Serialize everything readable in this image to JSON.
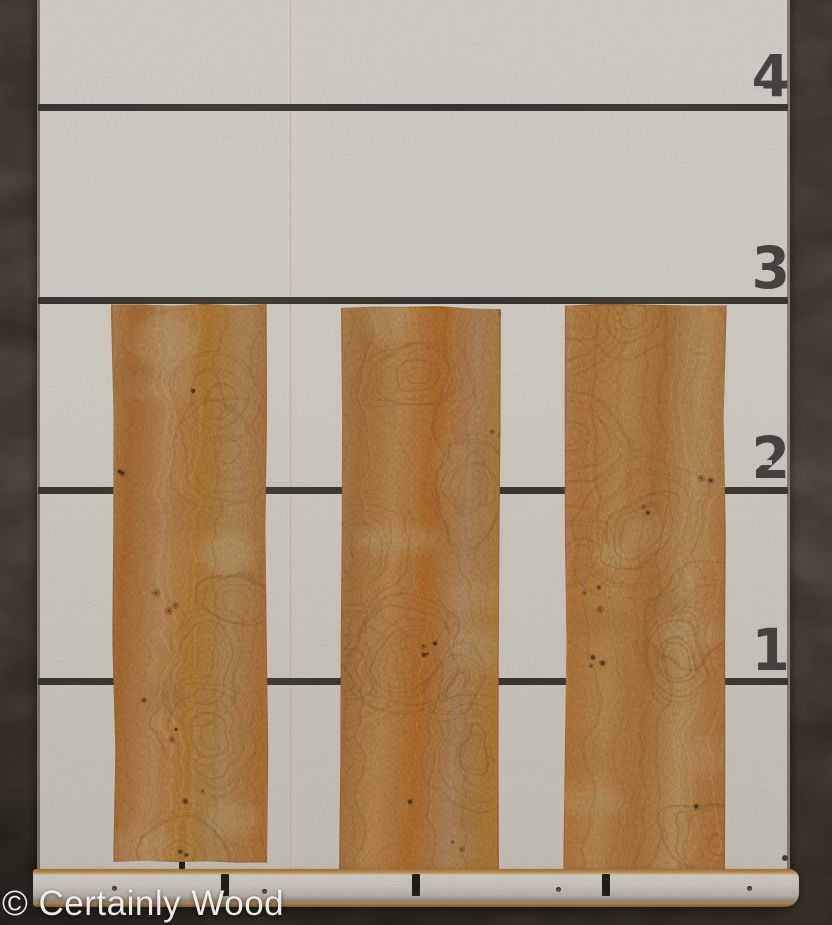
{
  "photo": {
    "watermark": "© Certainly Wood"
  },
  "scale": {
    "numbers": [
      "4",
      "3",
      "2",
      "1"
    ],
    "rail_tick_count": 3
  },
  "veneers": {
    "count": 3
  },
  "colors": {
    "floor": "#64594a",
    "floor_dark": "#4c4437",
    "board": "#d7d2ca",
    "board_low": "#cbc6bd",
    "line": "#35312b",
    "number": "#3c3833",
    "seam": "#b3a894",
    "tick": "#23211c",
    "rail_face": "#cfcac2",
    "rail_wood": "#bd8443",
    "rail_dark": "#6e6251",
    "veneer_base": "#dda55e",
    "veneer_dark": "#b97f3e",
    "knot": "#6f4423",
    "watermark": "#ffffff"
  }
}
